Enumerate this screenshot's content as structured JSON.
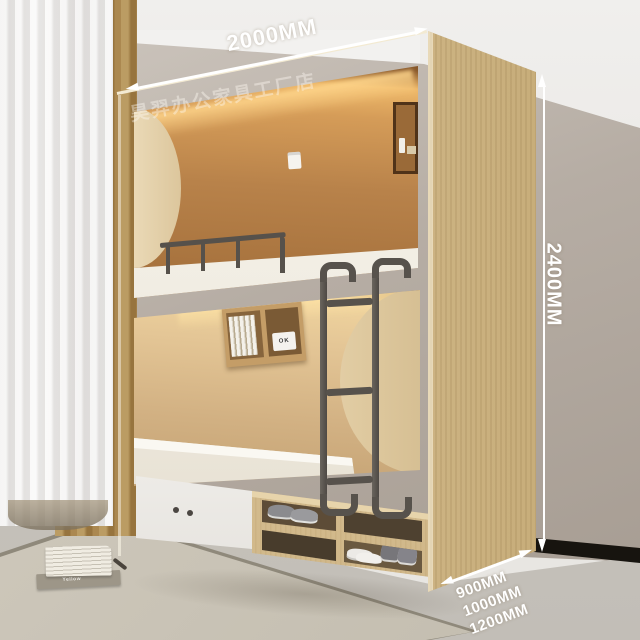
{
  "annotations": {
    "width_label": "2000MM",
    "height_label": "2400MM",
    "depth_labels": [
      "900MM",
      "1000MM",
      "1200MM"
    ],
    "watermark": "昊羿办公家具工厂店",
    "arrow_color": "#ffffff"
  },
  "details": {
    "clock_text": "OK",
    "magazine_text": "Yellow"
  },
  "palette": {
    "wood_front": "#dfcca6",
    "wood_side": "#cdb487",
    "interior_warm_wall": "#b5814a",
    "led_glow": "#f0bc70",
    "metal_dark": "#57524c",
    "wall_greige": "#b3aaa1",
    "floor_gray": "#c8c4bd",
    "rug_beige": "#ccc6b9",
    "curtain_tan": "#b08d55",
    "mattress_white": "#f1ede3",
    "drawer_white": "#f3f2ef",
    "skirting_black": "#17140f"
  }
}
